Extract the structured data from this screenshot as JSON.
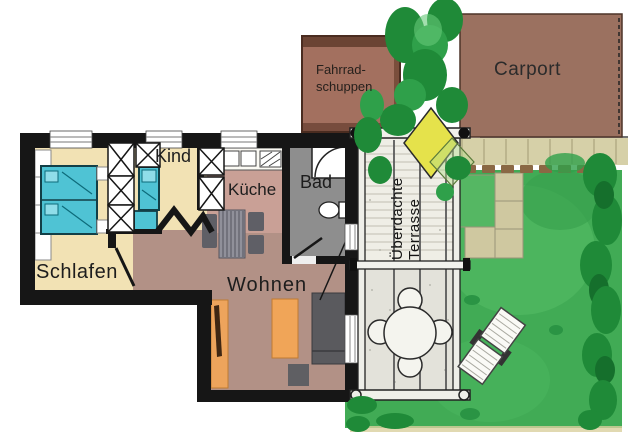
{
  "rooms": {
    "schlafen": "Schlafen",
    "kind": "Kind",
    "kueche": "Küche",
    "bad": "Bad",
    "wohnen": "Wohnen"
  },
  "outdoor": {
    "shed_line1": "Fahrrad-",
    "shed_line2": "schuppen",
    "carport": "Carport",
    "terrace_line1": "Überdachte",
    "terrace_line2": "Terrasse"
  },
  "colors": {
    "bedroom_floor": "#f2e2b4",
    "kitchen_floor": "#c9a096",
    "living_floor": "#b29186",
    "bath_floor": "#8e8e8e",
    "bed_furniture": "#4fc3d4",
    "orange_furniture": "#eda45c",
    "gray_furniture": "#5f5f63",
    "shed": "#a3705f",
    "carport": "#9b7160",
    "grass": "#41ab55",
    "hedge": "#1f8a38",
    "paving": "#cfc8a0",
    "wall": "#161616",
    "bush_yellow": "#e5e24b"
  }
}
